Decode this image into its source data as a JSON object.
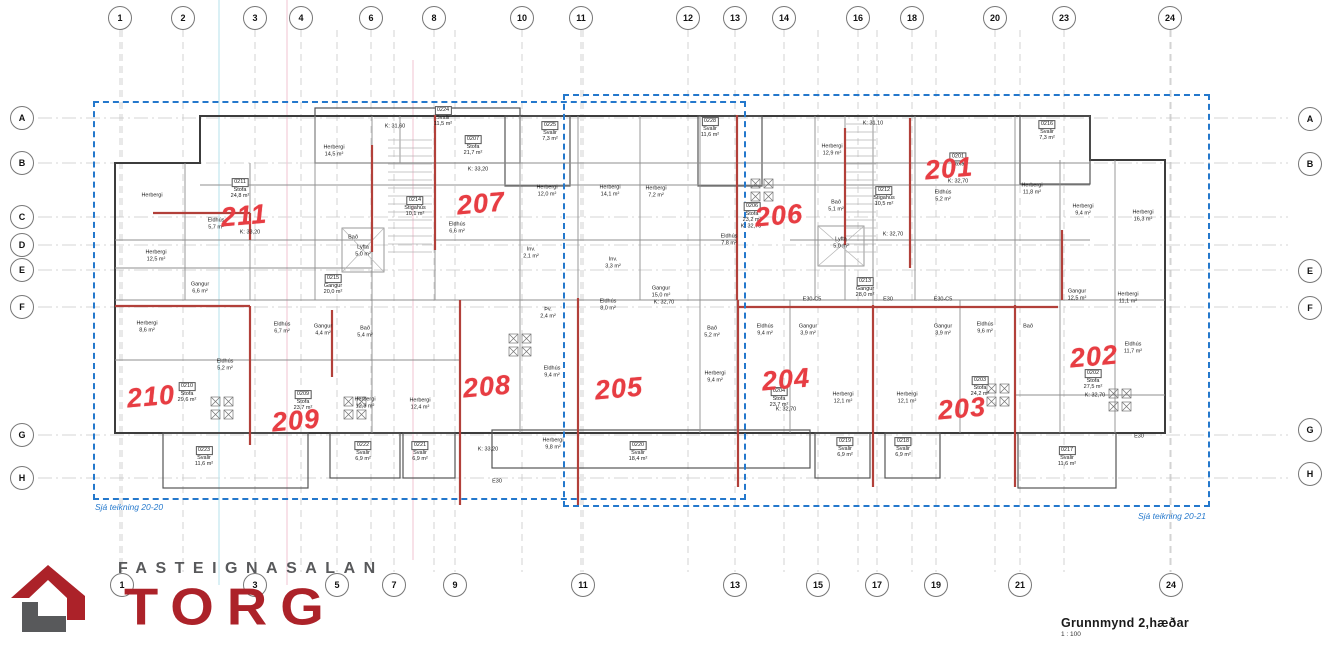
{
  "colors": {
    "red": "#e73d43",
    "planred": "#b2403a",
    "blue": "#2478cc",
    "logored": "#ac2229",
    "logogray": "#58595b",
    "ink": "#3c3c3c"
  },
  "logo": {
    "top_text": "FASTEIGNASALAN",
    "main_text": "TORG"
  },
  "title_block": {
    "title": "Grunnmynd 2,hæðar",
    "scale": "1 : 100"
  },
  "notes": {
    "left": "Sjá teikning 20-20",
    "right": "Sjá teikning 20-21"
  },
  "grid": {
    "top": [
      [
        "1",
        120
      ],
      [
        "2",
        183
      ],
      [
        "3",
        255
      ],
      [
        "4",
        301
      ],
      [
        "6",
        371
      ],
      [
        "8",
        434
      ],
      [
        "10",
        522
      ],
      [
        "11",
        581
      ],
      [
        "12",
        688
      ],
      [
        "13",
        735
      ],
      [
        "14",
        784
      ],
      [
        "16",
        858
      ],
      [
        "18",
        912
      ],
      [
        "20",
        995
      ],
      [
        "23",
        1064
      ],
      [
        "24",
        1170
      ]
    ],
    "bottom": [
      [
        "1",
        122
      ],
      [
        "3",
        255
      ],
      [
        "5",
        337
      ],
      [
        "7",
        394
      ],
      [
        "9",
        455
      ],
      [
        "11",
        583
      ],
      [
        "13",
        735
      ],
      [
        "15",
        818
      ],
      [
        "17",
        877
      ],
      [
        "19",
        936
      ],
      [
        "21",
        1020
      ],
      [
        "24",
        1171
      ]
    ],
    "left": [
      [
        "A",
        118
      ],
      [
        "B",
        163
      ],
      [
        "C",
        217
      ],
      [
        "D",
        245
      ],
      [
        "E",
        270
      ],
      [
        "F",
        307
      ],
      [
        "G",
        435
      ],
      [
        "H",
        478
      ]
    ],
    "right": [
      [
        "A",
        119
      ],
      [
        "B",
        164
      ],
      [
        "E",
        271
      ],
      [
        "F",
        308
      ],
      [
        "G",
        430
      ],
      [
        "H",
        474
      ]
    ]
  },
  "units": [
    [
      "211",
      244,
      216
    ],
    [
      "207",
      481,
      204
    ],
    [
      "206",
      779,
      216
    ],
    [
      "201",
      949,
      169
    ],
    [
      "210",
      151,
      397
    ],
    [
      "209",
      296,
      421
    ],
    [
      "208",
      487,
      387
    ],
    [
      "205",
      619,
      389
    ],
    [
      "204",
      786,
      380
    ],
    [
      "203",
      962,
      409
    ],
    [
      "202",
      1094,
      357
    ]
  ],
  "rooms": [
    [
      443,
      117,
      [
        "0224",
        "Svalir",
        "11,5 m²"
      ]
    ],
    [
      334,
      151,
      [
        "Herbergi",
        "14,5 m²"
      ]
    ],
    [
      240,
      189,
      [
        "0211",
        "Stofa",
        "24,8 m²"
      ]
    ],
    [
      216,
      224,
      [
        "Eldhús",
        "5,7 m²"
      ]
    ],
    [
      152,
      196,
      [
        "Herbergi"
      ]
    ],
    [
      156,
      256,
      [
        "Herbergi",
        "12,5 m²"
      ]
    ],
    [
      200,
      288,
      [
        "Gangur",
        "6,6 m²"
      ]
    ],
    [
      250,
      233,
      [
        "K: 33,20"
      ]
    ],
    [
      353,
      238,
      [
        "Bað"
      ]
    ],
    [
      363,
      251,
      [
        "Lyfta",
        "5,0 m²"
      ]
    ],
    [
      333,
      285,
      [
        "0215",
        "Gangur",
        "20,0 m²"
      ]
    ],
    [
      395,
      127,
      [
        "K: 31,60"
      ]
    ],
    [
      415,
      207,
      [
        "0214",
        "Stigahús",
        "10,1 m²"
      ]
    ],
    [
      473,
      146,
      [
        "0207",
        "Stofa",
        "21,7 m²"
      ]
    ],
    [
      478,
      170,
      [
        "K: 33,20"
      ]
    ],
    [
      550,
      132,
      [
        "0225",
        "Svalir",
        "7,3 m²"
      ]
    ],
    [
      457,
      228,
      [
        "Eldhús",
        "6,6 m²"
      ]
    ],
    [
      547,
      191,
      [
        "Herbergi",
        "12,0 m²"
      ]
    ],
    [
      610,
      191,
      [
        "Herbergi",
        "14,1 m²"
      ]
    ],
    [
      656,
      192,
      [
        "Herbergi",
        "7,2 m²"
      ]
    ],
    [
      531,
      253,
      [
        "Inv.",
        "2,1 m²"
      ]
    ],
    [
      613,
      263,
      [
        "Inv.",
        "3,3 m²"
      ]
    ],
    [
      661,
      292,
      [
        "Gangur",
        "15,0 m²"
      ]
    ],
    [
      664,
      303,
      [
        "K: 32,70"
      ]
    ],
    [
      608,
      305,
      [
        "Eldhús",
        "8,0 m²"
      ]
    ],
    [
      710,
      128,
      [
        "0228",
        "Svalir",
        "11,6 m²"
      ]
    ],
    [
      832,
      150,
      [
        "Herbergi",
        "12,9 m²"
      ]
    ],
    [
      873,
      124,
      [
        "K: 31,10"
      ]
    ],
    [
      752,
      213,
      [
        "0206",
        "Stofa",
        "23,2 m²"
      ]
    ],
    [
      751,
      227,
      [
        "K: 32,70"
      ]
    ],
    [
      729,
      240,
      [
        "Eldhús",
        "7,8 m²"
      ]
    ],
    [
      841,
      243,
      [
        "Lyfta",
        "5,0 m²"
      ]
    ],
    [
      884,
      197,
      [
        "0212",
        "Stigahús",
        "10,5 m²"
      ]
    ],
    [
      836,
      206,
      [
        "Bað",
        "5,1 m²"
      ]
    ],
    [
      893,
      235,
      [
        "K: 32,70"
      ]
    ],
    [
      865,
      288,
      [
        "0213",
        "Gangur",
        "28,0 m²"
      ]
    ],
    [
      958,
      160,
      [
        "0201",
        "Stofa"
      ]
    ],
    [
      958,
      182,
      [
        "K: 32,70"
      ]
    ],
    [
      943,
      196,
      [
        "Eldhús",
        "5,2 m²"
      ]
    ],
    [
      1047,
      131,
      [
        "0216",
        "Svalir",
        "7,3 m²"
      ]
    ],
    [
      1032,
      189,
      [
        "Herbergi",
        "11,8 m²"
      ]
    ],
    [
      1083,
      210,
      [
        "Herbergi",
        "9,4 m²"
      ]
    ],
    [
      1143,
      216,
      [
        "Herbergi",
        "16,3 m²"
      ]
    ],
    [
      1077,
      295,
      [
        "Gangur",
        "12,5 m²"
      ]
    ],
    [
      1128,
      298,
      [
        "Herbergi",
        "11,1 m²"
      ]
    ],
    [
      1028,
      327,
      [
        "Bað"
      ]
    ],
    [
      1133,
      348,
      [
        "Eldhús",
        "11,7 m²"
      ]
    ],
    [
      1093,
      380,
      [
        "0202",
        "Stofa",
        "27,5 m²"
      ]
    ],
    [
      1095,
      396,
      [
        "K: 32,70"
      ]
    ],
    [
      1067,
      457,
      [
        "0217",
        "Svalir",
        "11,6 m²"
      ]
    ],
    [
      147,
      327,
      [
        "Herbergi",
        "8,6 m²"
      ]
    ],
    [
      187,
      393,
      [
        "0210",
        "Stofa",
        "29,6 m²"
      ]
    ],
    [
      225,
      365,
      [
        "Eldhús",
        "5,2 m²"
      ]
    ],
    [
      282,
      328,
      [
        "Eldhús",
        "6,7 m²"
      ]
    ],
    [
      323,
      330,
      [
        "Gangur",
        "4,4 m²"
      ]
    ],
    [
      365,
      332,
      [
        "Bað",
        "5,4 m²"
      ]
    ],
    [
      303,
      401,
      [
        "0209",
        "Stofa",
        "23,7 m²"
      ]
    ],
    [
      365,
      403,
      [
        "Herbergi",
        "12,3 m²"
      ]
    ],
    [
      420,
      404,
      [
        "Herbergi",
        "12,4 m²"
      ]
    ],
    [
      204,
      457,
      [
        "0223",
        "Svalir",
        "11,6 m²"
      ]
    ],
    [
      363,
      452,
      [
        "0222",
        "Svalir",
        "6,9 m²"
      ]
    ],
    [
      420,
      452,
      [
        "0221",
        "Svalir",
        "6,9 m²"
      ]
    ],
    [
      488,
      450,
      [
        "K: 33,20"
      ]
    ],
    [
      553,
      444,
      [
        "Herbergi",
        "9,8 m²"
      ]
    ],
    [
      552,
      372,
      [
        "Eldhús",
        "9,4 m²"
      ]
    ],
    [
      548,
      313,
      [
        "Þv.",
        "2,4 m²"
      ]
    ],
    [
      712,
      332,
      [
        "Bað",
        "5,2 m²"
      ]
    ],
    [
      715,
      377,
      [
        "Herbergi",
        "9,4 m²"
      ]
    ],
    [
      638,
      452,
      [
        "0220",
        "Svalir",
        "18,4 m²"
      ]
    ],
    [
      765,
      330,
      [
        "Eldhús",
        "9,4 m²"
      ]
    ],
    [
      808,
      330,
      [
        "Gangur",
        "3,9 m²"
      ]
    ],
    [
      779,
      398,
      [
        "0204",
        "Stofa",
        "23,7 m²"
      ]
    ],
    [
      786,
      410,
      [
        "K: 32,70"
      ]
    ],
    [
      843,
      398,
      [
        "Herbergi",
        "12,1 m²"
      ]
    ],
    [
      907,
      398,
      [
        "Herbergi",
        "12,1 m²"
      ]
    ],
    [
      943,
      330,
      [
        "Gangur",
        "3,9 m²"
      ]
    ],
    [
      985,
      328,
      [
        "Eldhús",
        "9,6 m²"
      ]
    ],
    [
      980,
      387,
      [
        "0203",
        "Stofa",
        "24,2 m²"
      ]
    ],
    [
      845,
      448,
      [
        "0219",
        "Svalir",
        "6,9 m²"
      ]
    ],
    [
      903,
      448,
      [
        "0218",
        "Svalir",
        "6,9 m²"
      ]
    ],
    [
      812,
      300,
      [
        "E30-C5"
      ]
    ],
    [
      888,
      300,
      [
        "E30"
      ]
    ],
    [
      943,
      300,
      [
        "E30-C5"
      ]
    ],
    [
      497,
      482,
      [
        "E30"
      ]
    ],
    [
      1139,
      437,
      [
        "E30"
      ]
    ]
  ]
}
